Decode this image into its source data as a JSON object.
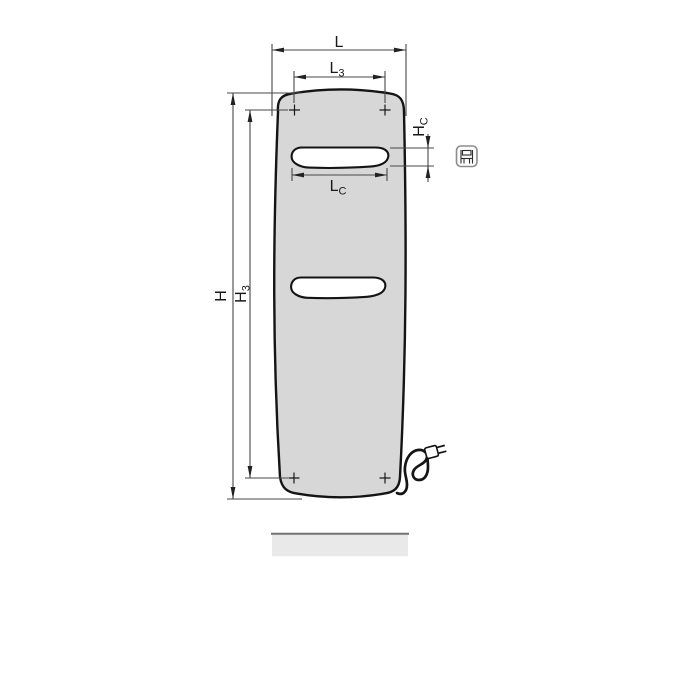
{
  "diagram": {
    "kind": "radiator dimensional drawing",
    "dimension_labels": {
      "L": {
        "main": "L",
        "sub": ""
      },
      "L3": {
        "main": "L",
        "sub": "3"
      },
      "LC": {
        "main": "L",
        "sub": "C"
      },
      "H": {
        "main": "H",
        "sub": ""
      },
      "H3": {
        "main": "H",
        "sub": "3"
      },
      "HC": {
        "main": "H",
        "sub": "C"
      }
    },
    "icons": [
      {
        "name": "electric-connection-pictogram",
        "description": "small rounded square with mini radiator/plug glyph, right of top cutout"
      }
    ],
    "features": {
      "mounting_points": 4,
      "cutout_slots": 2,
      "power_cord_with_plug": true,
      "floor_bar": true
    },
    "colors": {
      "background": "#ffffff",
      "radiator_fill": "#d7d7d7",
      "outline": "#141414",
      "dimension_lines": "#474747",
      "floor_bar_fill": "#e9e9e9",
      "floor_bar_edge": "#707070",
      "icon_border": "#8d8d8d"
    }
  }
}
